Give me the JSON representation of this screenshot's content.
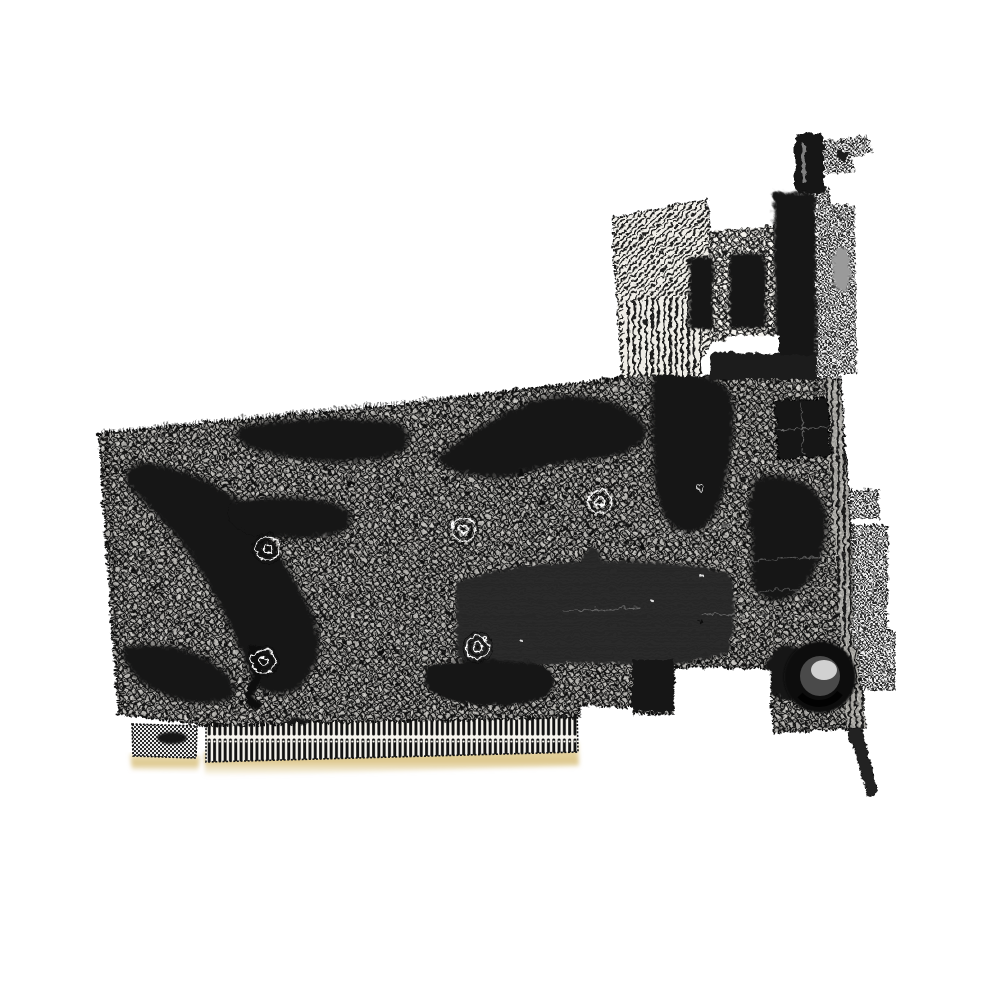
{
  "image": {
    "width": 1000,
    "height": 1000,
    "background": "#ffffff",
    "alt": "Black-and-white dithered halftone product photo of a PCI graphics expansion card viewed at an angle on a white background",
    "style": "1-bit ordered-dither halftone, monochrome with faint gold tint on edge connector"
  },
  "card": {
    "parts": {
      "pcb": {
        "label": "PCB main board",
        "color": "#1a1a1a"
      },
      "shadows": {
        "label": "Dark shadow blotches and traces on PCB"
      },
      "edge_connector": {
        "label": "Gold-finger edge connector",
        "color": "#e0cb93"
      },
      "edge_connector_key": {
        "label": "Short key segment of edge connector"
      },
      "bracket": {
        "label": "Metal mounting bracket",
        "color": "#9a9a9a"
      },
      "bracket_tab": {
        "label": "Bracket screw tab"
      },
      "bracket_leg": {
        "label": "Bracket lower leg"
      },
      "bracket_folds": {
        "label": "Bracket side folds near ports"
      },
      "heatsink": {
        "label": "Finned heatsink / shroud on top edge"
      },
      "ports": {
        "label": "Display output port block (DVI / HDMI)"
      },
      "port_screw": {
        "label": "Port thumbscrew post"
      },
      "gpu": {
        "label": "GPU chip package"
      },
      "capacitor": {
        "label": "Electrolytic capacitor"
      },
      "vias": {
        "label": "Vias and screw-hole rosettes"
      }
    },
    "colors": {
      "background": "#ffffff",
      "ink": "#151515",
      "halftone_mid": "#555555",
      "bracket_gray": "#9a9a9a",
      "gold": "#e0cb93"
    }
  }
}
